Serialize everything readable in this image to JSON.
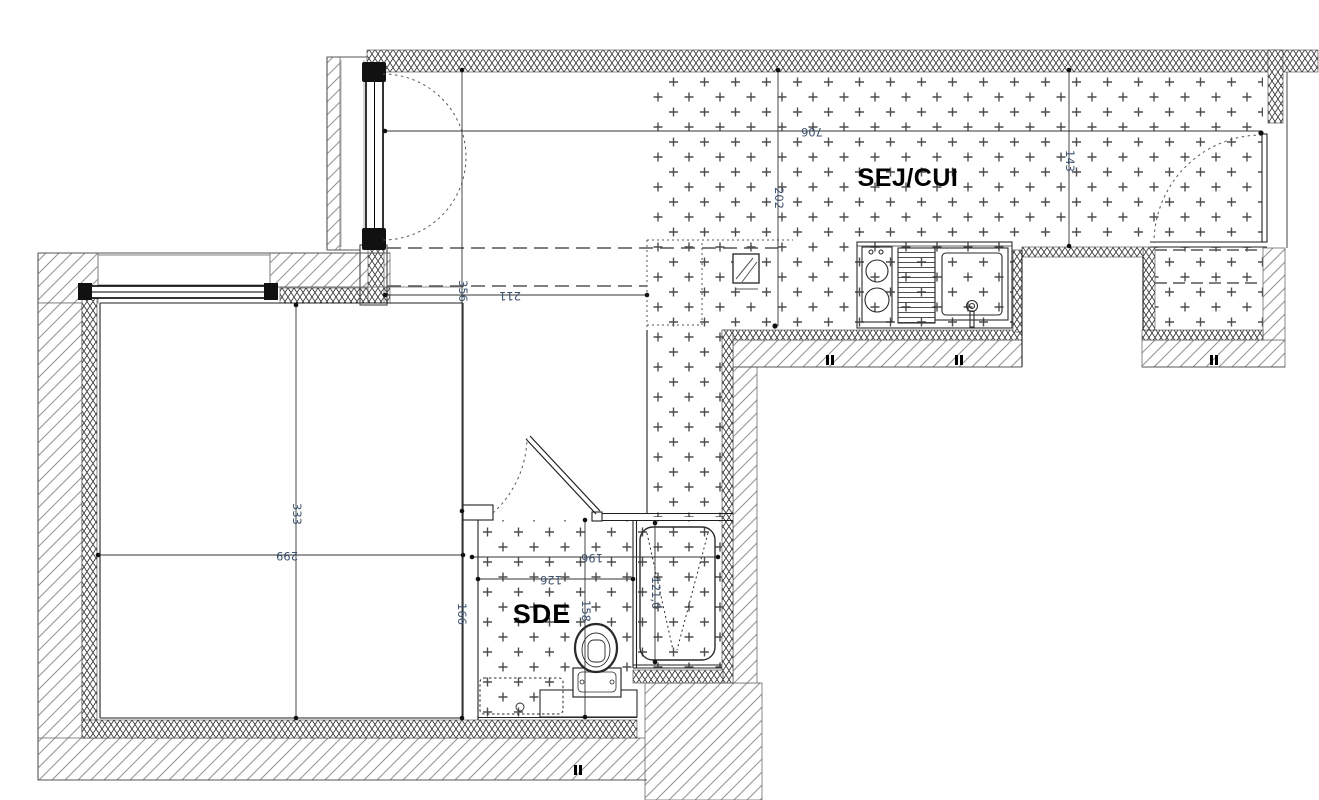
{
  "rooms": {
    "living_kitchen": "SEJ/CUI",
    "shower_room": "SDE"
  },
  "dims": {
    "d706": "706",
    "d202": "202",
    "d143": "143",
    "d211": "211",
    "d356": "356",
    "d299": "299",
    "d333": "333",
    "d166": "166",
    "d196": "196",
    "d126": "126",
    "d158": "158",
    "d121": "121,0"
  },
  "colors": {
    "dimension_text": "#3e536f",
    "line": "#1f1f1f",
    "hatch": "#909090"
  }
}
